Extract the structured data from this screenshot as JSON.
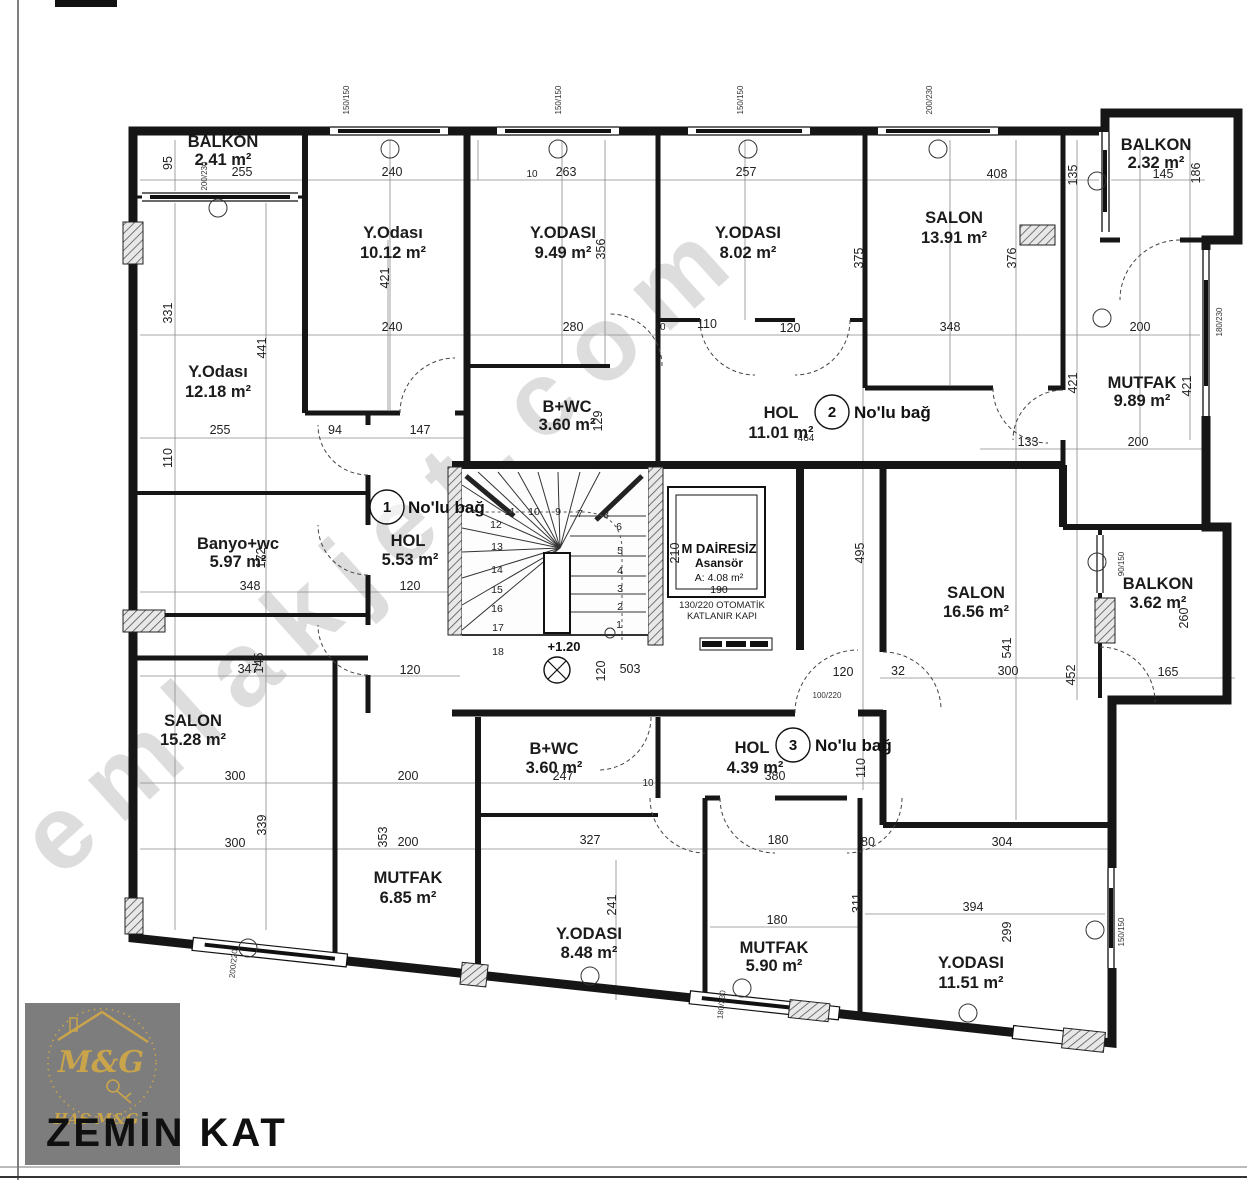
{
  "title": "ZEMİN KAT",
  "logo": {
    "monogram": "M&G",
    "brand": "HAS M&G"
  },
  "watermark": "emlakjet.com",
  "level_mark": "+1.20",
  "rooms": [
    {
      "name": "BALKON",
      "area": "2.41 m²"
    },
    {
      "name": "Y.Odası",
      "area": "10.12 m²"
    },
    {
      "name": "Y.ODASI",
      "area": "9.49 m²"
    },
    {
      "name": "Y.ODASI",
      "area": "8.02 m²"
    },
    {
      "name": "SALON",
      "area": "13.91 m²"
    },
    {
      "name": "BALKON",
      "area": "2.32 m²"
    },
    {
      "name": "Y.Odası",
      "area": "12.18 m²"
    },
    {
      "name": "B+WC",
      "area": "3.60 m²"
    },
    {
      "name": "HOL",
      "area": "11.01 m²"
    },
    {
      "name": "MUTFAK",
      "area": "9.89 m²"
    },
    {
      "name": "Banyo+wc",
      "area": "5.97 m²"
    },
    {
      "name": "HOL",
      "area": "5.53 m²"
    },
    {
      "name": "SALON",
      "area": "16.56 m²"
    },
    {
      "name": "BALKON",
      "area": "3.62 m²"
    },
    {
      "name": "SALON",
      "area": "15.28 m²"
    },
    {
      "name": "B+WC",
      "area": "3.60 m²"
    },
    {
      "name": "HOL",
      "area": "4.39 m²"
    },
    {
      "name": "MUTFAK",
      "area": "6.85 m²"
    },
    {
      "name": "Y.ODASI",
      "area": "8.48 m²"
    },
    {
      "name": "MUTFAK",
      "area": "5.90 m²"
    },
    {
      "name": "Y.ODASI",
      "area": "11.51 m²"
    }
  ],
  "bags": [
    {
      "num": "1",
      "label": "No'lu bağ"
    },
    {
      "num": "2",
      "label": "No'lu bağ"
    },
    {
      "num": "3",
      "label": "No'lu bağ"
    }
  ],
  "elevator": {
    "line1": "M DAİRESİZ",
    "line2": "Asansör",
    "area": "A: 4.08 m²",
    "width": "190",
    "door_note1": "130/220 OTOMATİK",
    "door_note2": "KATLANIR KAPI"
  },
  "stairs": {
    "steps": [
      "1",
      "2",
      "3",
      "4",
      "5",
      "6",
      "7",
      "8",
      "9",
      "10",
      "11",
      "12",
      "13",
      "14",
      "15",
      "16",
      "17",
      "18"
    ]
  },
  "dims_h": [
    "255",
    "240",
    "263",
    "257",
    "408",
    "145",
    "240",
    "280",
    "110",
    "120",
    "348",
    "200",
    "255",
    "94",
    "147",
    "133",
    "200",
    "348",
    "120",
    "347",
    "120",
    "503",
    "120",
    "32",
    "300",
    "165",
    "300",
    "200",
    "247",
    "380",
    "300",
    "200",
    "327",
    "180",
    "80",
    "304",
    "180",
    "394",
    "464",
    "10",
    "10",
    "10"
  ],
  "dims_v": [
    "95",
    "331",
    "110",
    "441",
    "421",
    "356",
    "375",
    "376",
    "135",
    "186",
    "421",
    "421",
    "129",
    "172",
    "145",
    "339",
    "495",
    "210",
    "120",
    "541",
    "452",
    "260",
    "110",
    "353",
    "241",
    "311",
    "299"
  ],
  "dims_small": [
    "150/150",
    "150/150",
    "150/150",
    "200/230",
    "200/230",
    "180/230",
    "90/150",
    "150/150",
    "200/220",
    "180/230",
    "100/220"
  ]
}
